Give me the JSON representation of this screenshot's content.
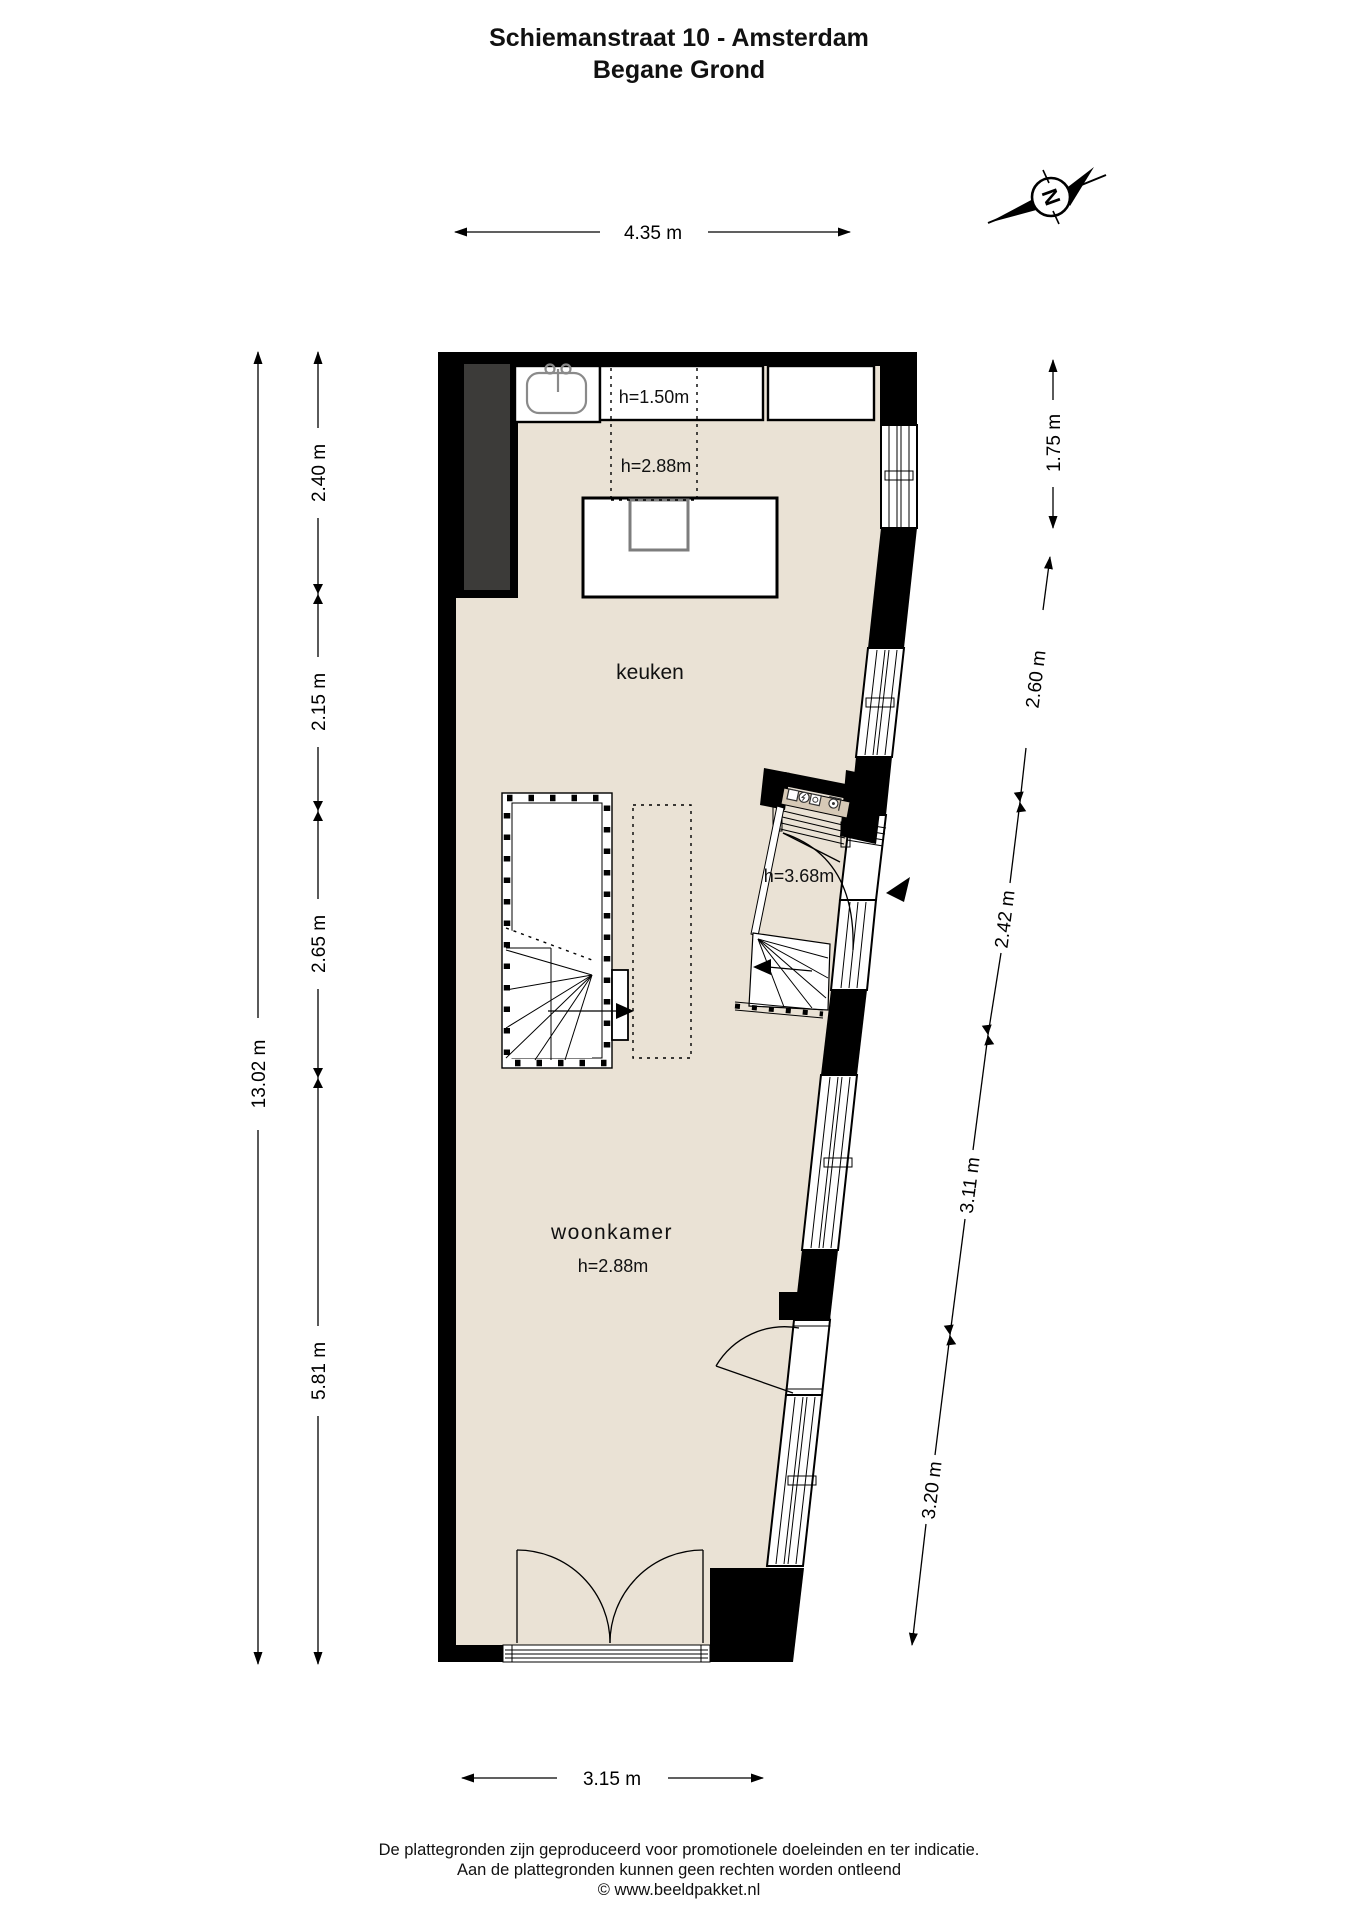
{
  "title": {
    "line1": "Schiemanstraat 10 - Amsterdam",
    "line2": "Begane Grond"
  },
  "compass": {
    "letter": "N"
  },
  "labels": {
    "keuken": "keuken",
    "woonkamer": "woonkamer",
    "h_counter": "h=1.50m",
    "h_kitchen": "h=2.88m",
    "h_entrance": "h=3.68m",
    "h_woonkamer": "h=2.88m"
  },
  "dimensions": {
    "top": "4.35 m",
    "bottom": "3.15 m",
    "left_total": "13.02 m",
    "left_segments": [
      "2.40 m",
      "2.15 m",
      "2.65 m",
      "5.81 m"
    ],
    "right_top": "1.75 m",
    "right_segments": [
      "2.60 m",
      "2.42 m",
      "3.11 m",
      "3.20 m"
    ]
  },
  "footer": {
    "line1": "De plattegronden zijn geproduceerd voor promotionele doeleinden en ter indicatie.",
    "line2": "Aan de plattegronden kunnen geen rechten worden ontleend",
    "line3": "© www.beeldpakket.nl"
  },
  "colors": {
    "floor": "#eae2d5",
    "wall": "#000000",
    "closet": "#3c3b39",
    "meter_cabinet": "#d6c9b6"
  }
}
